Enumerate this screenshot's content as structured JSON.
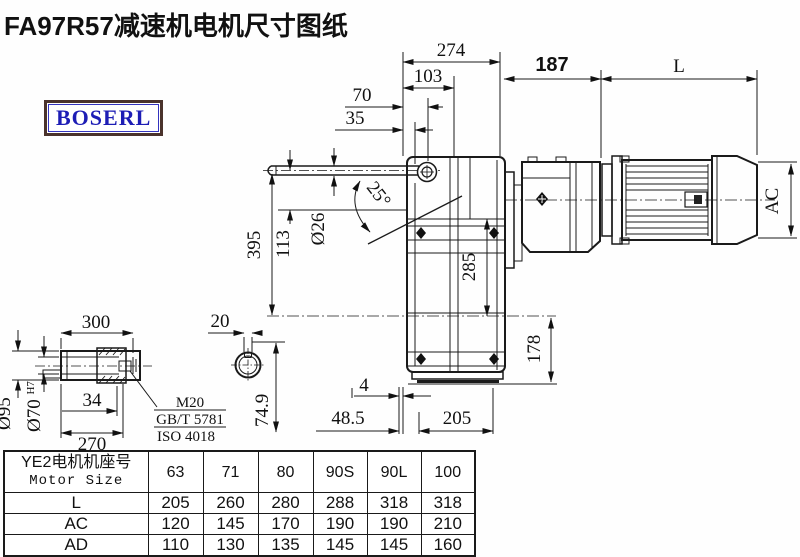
{
  "title": "FA97R57减速机电机尺寸图纸",
  "logo": "BOSERL",
  "drawing": {
    "top": {
      "d274": "274",
      "d103": "103",
      "d70": "70",
      "d35": "35",
      "d187": "187",
      "dL": "L"
    },
    "left": {
      "d395": "395",
      "d113": "113",
      "d26": "Ø26",
      "d25": "25°"
    },
    "body": {
      "d285": "285",
      "d178": "178",
      "dAC": "AC"
    },
    "bottom": {
      "d4": "4",
      "d485": "48.5",
      "d205": "205"
    },
    "shaft": {
      "d300": "300",
      "d95": "Ø95",
      "d70": "Ø70",
      "d70sup": "H7",
      "d34": "34",
      "d270": "270",
      "d20": "20",
      "d749": "74.9",
      "note1": "M20",
      "note2": "GB/T 5781",
      "note3": "ISO 4018"
    }
  },
  "table": {
    "header_cn": "YE2电机机座号",
    "header_en": "Motor Size",
    "sizes": [
      "63",
      "71",
      "80",
      "90S",
      "90L",
      "100"
    ],
    "rows": [
      {
        "label": "L",
        "values": [
          "205",
          "260",
          "280",
          "288",
          "318",
          "318"
        ]
      },
      {
        "label": "AC",
        "values": [
          "120",
          "145",
          "170",
          "190",
          "190",
          "210"
        ]
      },
      {
        "label": "AD",
        "values": [
          "110",
          "130",
          "135",
          "145",
          "145",
          "160"
        ]
      }
    ]
  }
}
